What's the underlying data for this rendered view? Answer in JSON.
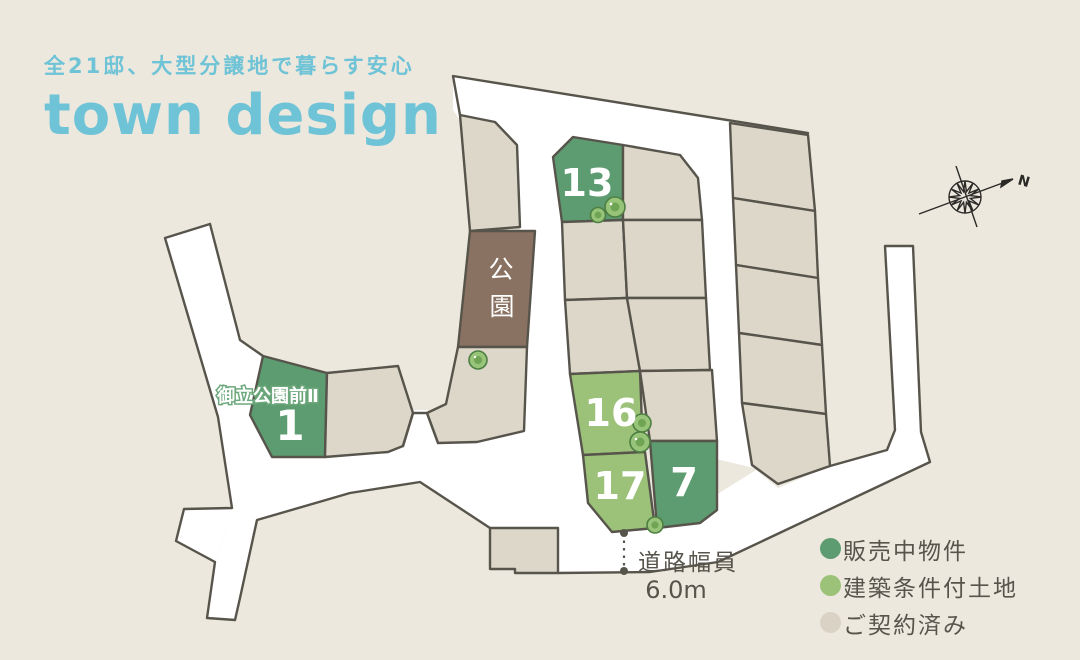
{
  "header": {
    "subtitle": "全21邸、大型分譲地で暮らす安心",
    "title": "town design"
  },
  "map": {
    "project_label": "御立公園前Ⅱ",
    "park_label": "公園",
    "park_label_chars": [
      "公",
      "園"
    ],
    "north_label": "N",
    "road_width": {
      "label": "道路幅員",
      "value": "6.0m"
    },
    "lots": {
      "lot_1": {
        "number": "1",
        "status": "販売中物件"
      },
      "lot_13": {
        "number": "13",
        "status": "販売中物件"
      },
      "lot_7": {
        "number": "7",
        "status": "販売中物件"
      },
      "lot_16": {
        "number": "16",
        "status": "建築条件付土地"
      },
      "lot_17": {
        "number": "17",
        "status": "建築条件付土地"
      }
    }
  },
  "legend": {
    "items": [
      {
        "label": "販売中物件",
        "color": "#5d9c71"
      },
      {
        "label": "建築条件付土地",
        "color": "#9cc178"
      },
      {
        "label": "ご契約済み",
        "color": "#d9d2c5"
      }
    ]
  },
  "colors": {
    "background": "#ece8de",
    "road": "#ffffff",
    "outline": "#57544c",
    "lot_contracted": "#ddd7ca",
    "lot_for_sale": "#5d9c71",
    "lot_conditional": "#9cc178",
    "park": "#8a7262",
    "accent_title": "#6fc3d6",
    "text": "#57544c"
  }
}
